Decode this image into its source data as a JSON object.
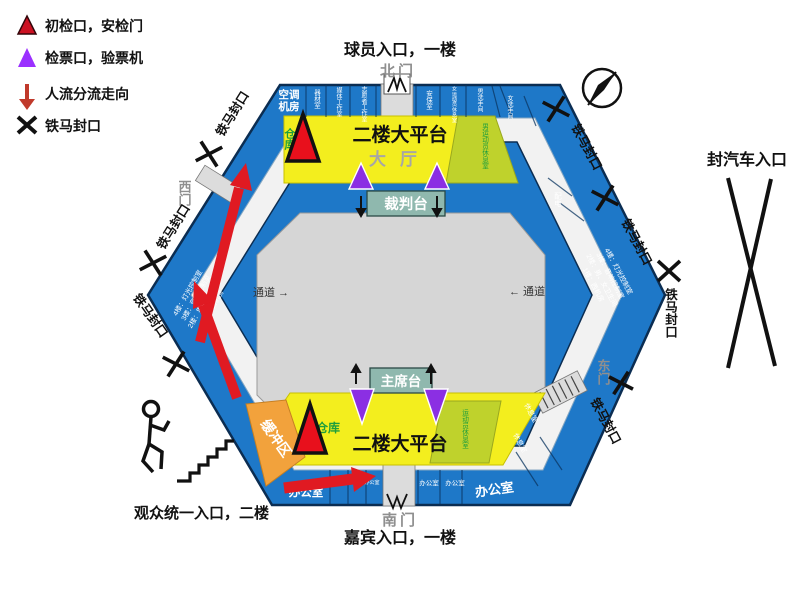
{
  "legend": {
    "first_check": "初检口，安检门",
    "ticket_check": "检票口，验票机",
    "flow": "人流分流走向",
    "barrier": "铁马封口"
  },
  "labels": {
    "player_entrance": "球员入口，一楼",
    "north_gate": "北门",
    "south_gate": "南门",
    "guest_entrance": "嘉宾入口，一楼",
    "audience_entrance": "观众统一入口，二楼",
    "car_entrance": "封汽车入口",
    "west_gate": "西门",
    "east_gate": "东门",
    "barrier": "铁马封口"
  },
  "arena": {
    "platform": "二楼大平台",
    "hall": "大厅",
    "referee_stand": "裁判台",
    "rostrum": "主席台",
    "corridor_left": "通道 →",
    "corridor_right": "← 通道",
    "buffer_zone": "缓冲区",
    "warehouse": "仓库",
    "office": "办公室",
    "rest_room": "休息室",
    "power_room": "配电",
    "lounge_top": "男运动员休息室",
    "lounge_bottom": "运动员休息室",
    "hvac": [
      "空调",
      "机房"
    ],
    "top_rooms": [
      "器材室",
      "媒体工作室",
      "志愿者工作室",
      "安保室",
      "女运动员休息室",
      "男洗手间",
      "女洗手间"
    ],
    "floors": [
      "4楼：灯光控制室",
      "3楼：音响控制室",
      "2楼：男、女卫生间",
      "1楼：西机房"
    ]
  },
  "colors": {
    "band_blue": "#1e78c8",
    "court_gray": "#d6d6d6",
    "ring_gray": "#f2f2f2",
    "platform_yellow": "#f3ee1e",
    "lounge_olive": "#bfd22c",
    "buffer_orange": "#f2a23c",
    "stage_teal": "#8fb8ae",
    "check_red": "#e8101c",
    "ticket_purple": "#8b2fe3",
    "flow_red": "#e01a22"
  }
}
